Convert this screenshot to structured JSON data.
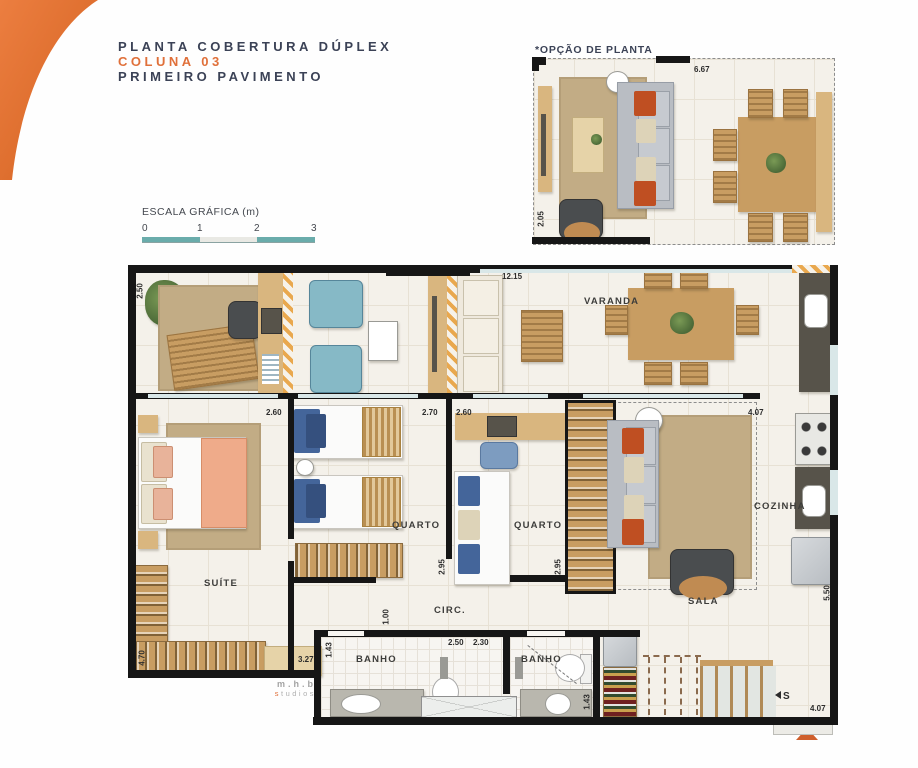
{
  "header": {
    "title": "PLANTA COBERTURA DÚPLEX",
    "coluna": "COLUNA 03",
    "pavimento": "PRIMEIRO PAVIMENTO"
  },
  "inset": {
    "label": "*OPÇÃO DE PLANTA",
    "dims": {
      "width": "6.67",
      "depth": "2.05"
    }
  },
  "scale": {
    "label": "ESCALA GRÁFICA (m)",
    "ticks": [
      "0",
      "1",
      "2",
      "3"
    ]
  },
  "plan": {
    "room_labels": {
      "varanda": "VARANDA",
      "suite": "SUÍTE",
      "quarto1": "QUARTO",
      "quarto2": "QUARTO",
      "sala": "SALA",
      "cozinha": "COZINHA",
      "circ": "CIRC.",
      "banho1": "BANHO",
      "banho2": "BANHO"
    },
    "stairs": {
      "label": "S"
    },
    "dims": {
      "varanda_width": "12.15",
      "varanda_depth": "2.50",
      "suite_width": "2.60",
      "quarto1_width": "2.70",
      "quarto2_width": "2.60",
      "sala_width": "4.07",
      "quarto1_depth": "2.95",
      "quarto2_depth": "2.95",
      "sala_depth": "5.50",
      "circ_width": "1.00",
      "banho1_depth": "1.43",
      "banho1_width": "2.50",
      "banho2_width": "2.30",
      "banho2_depth": "1.43",
      "suite_shelf": "3.27",
      "suite_depth": "4.70",
      "kitchen_width": "4.07"
    }
  },
  "credit": {
    "line1": "m.h.b",
    "line2": "studios"
  }
}
